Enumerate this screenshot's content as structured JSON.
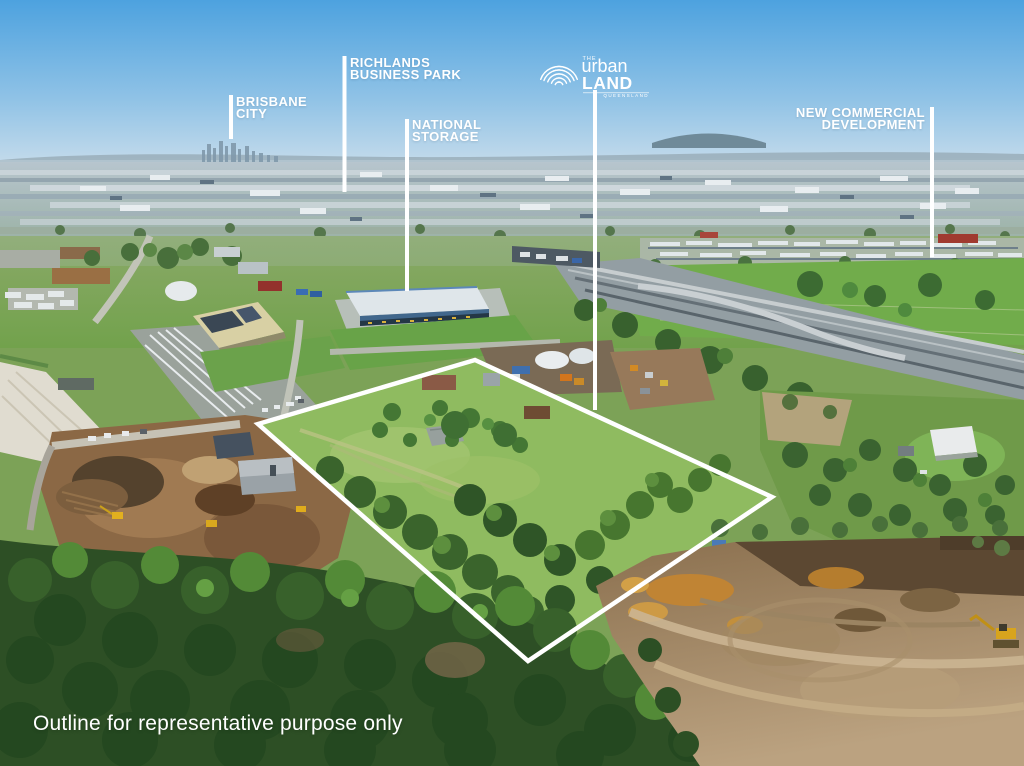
{
  "annotations": {
    "brisbane_city": {
      "line1": "BRISBANE",
      "line2": "CITY"
    },
    "richlands_business_park": {
      "line1": "RICHLANDS",
      "line2": "BUSINESS PARK"
    },
    "national_storage": {
      "line1": "NATIONAL",
      "line2": "STORAGE"
    },
    "new_commercial_development": {
      "line1": "NEW COMMERCIAL",
      "line2": "DEVELOPMENT"
    }
  },
  "logo": {
    "prefix": "THE",
    "top": "urban",
    "bottom": "LAND",
    "region": "QUEENSLAND"
  },
  "disclaimer": "Outline for representative purpose only",
  "outline": {
    "points": "475,360 772,497 528,661 258,424",
    "color": "#ffffff"
  },
  "colors": {
    "overlay": "#ffffff",
    "sky_top": "#4da2df",
    "field_green": "#8fbb60",
    "earth_tan": "#b29872"
  }
}
